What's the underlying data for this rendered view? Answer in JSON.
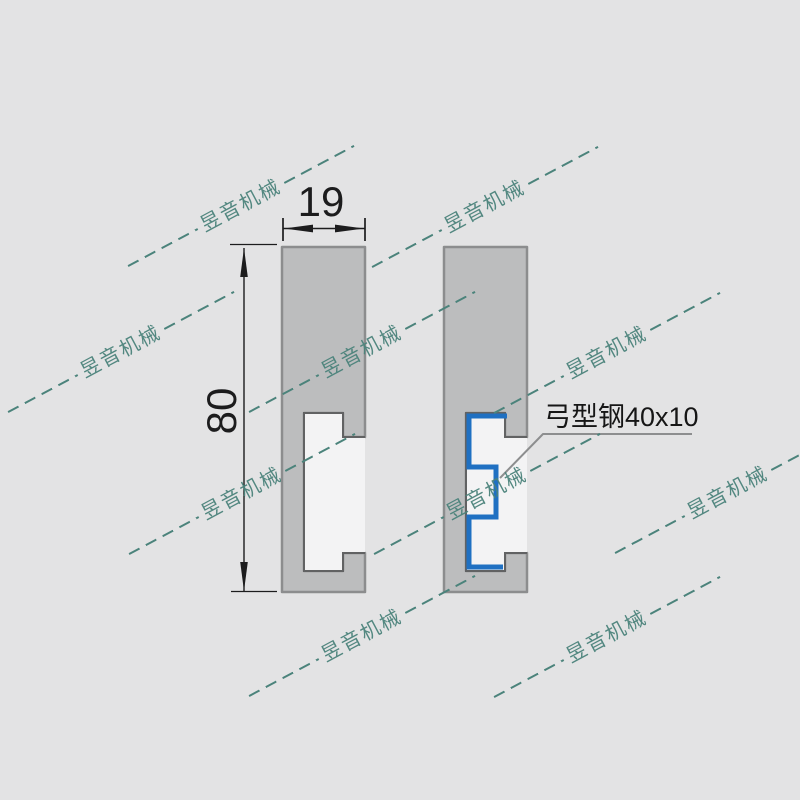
{
  "canvas": {
    "width": 800,
    "height": 800
  },
  "colors": {
    "bg": "#e3e3e4",
    "profile_fill": "#bcbdbe",
    "profile_stroke": "#8c8d8e",
    "groove_fill": "#f3f3f4",
    "groove_stroke": "#616263",
    "insert_blue": "#1f70c2",
    "watermark": "#4b837b",
    "dim_ink": "#1c1c1d",
    "leader": "#8d8e8f"
  },
  "dimensions": {
    "width_value": "19",
    "height_value": "80"
  },
  "callout": {
    "label": "弓型钢40x10"
  },
  "watermark": {
    "text": "昱音机械",
    "angle_deg": -28,
    "instances": [
      {
        "x": 241,
        "y": 206
      },
      {
        "x": 485,
        "y": 207
      },
      {
        "x": 121,
        "y": 352
      },
      {
        "x": 362,
        "y": 352
      },
      {
        "x": 607,
        "y": 353
      },
      {
        "x": 242,
        "y": 494
      },
      {
        "x": 487,
        "y": 494
      },
      {
        "x": 728,
        "y": 493
      },
      {
        "x": 362,
        "y": 636
      },
      {
        "x": 607,
        "y": 637
      }
    ]
  }
}
